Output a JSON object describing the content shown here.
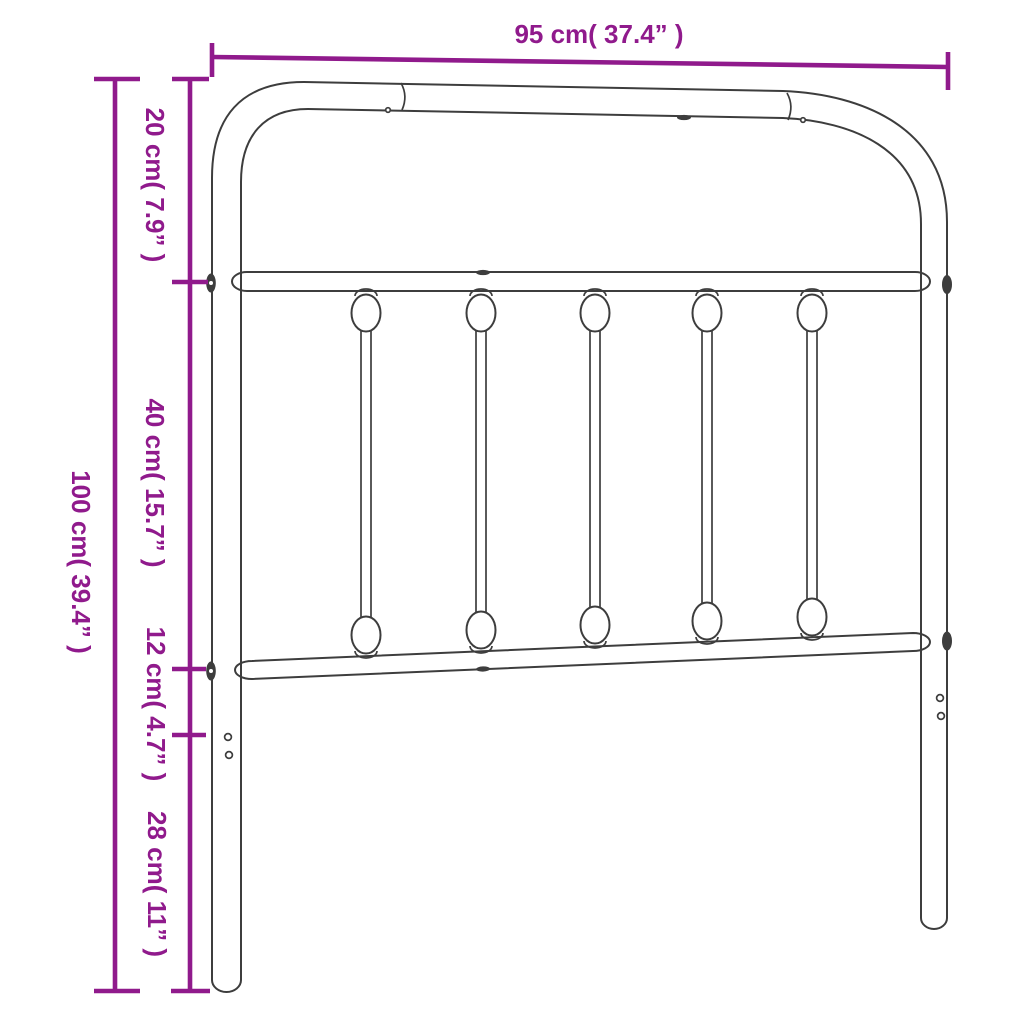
{
  "diagram": {
    "labels": {
      "width": "95 cm( 37.4” )",
      "height_total": "100 cm( 39.4” )",
      "segment_top": "20 cm( 7.9” )",
      "segment_middle": "40 cm( 15.7” )",
      "segment_rail": "12 cm( 4.7” )",
      "segment_bottom": "28 cm( 11” )"
    },
    "colors": {
      "dimension": "#901A8C",
      "outline": "#3D3D3D",
      "background": "#FFFFFF"
    }
  }
}
